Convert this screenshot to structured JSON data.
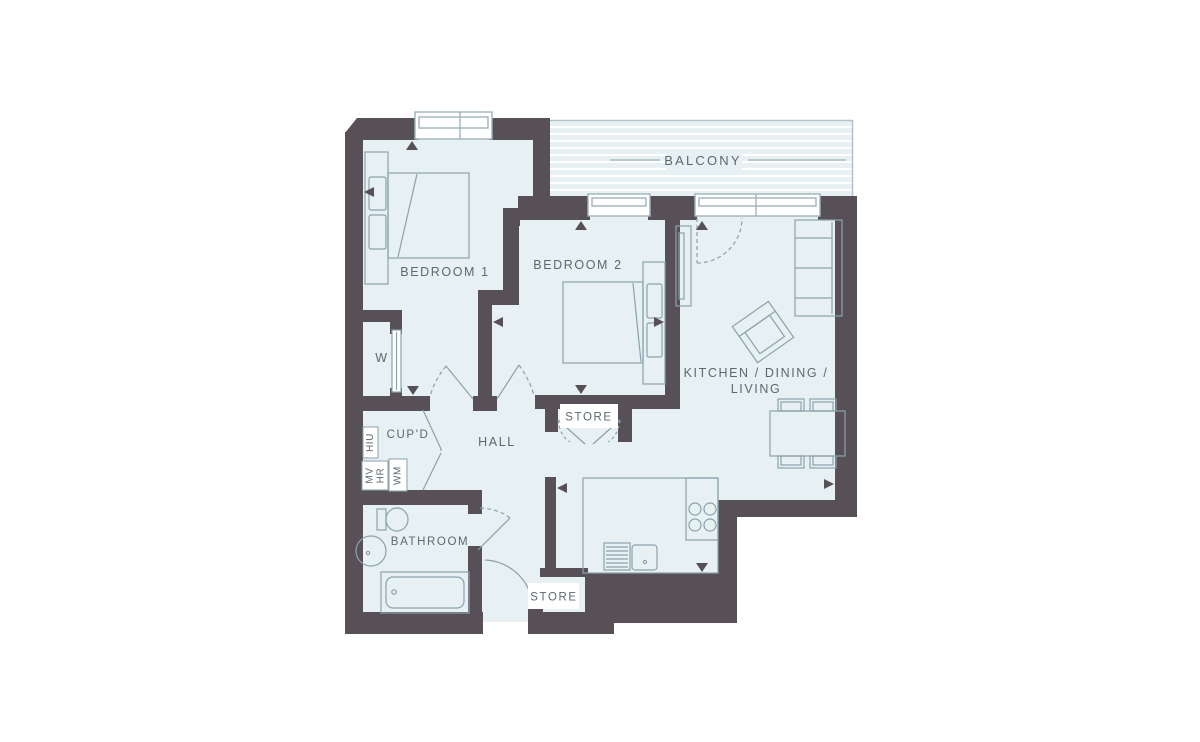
{
  "plan_title": "Two bedroom apartment floor plan",
  "colors": {
    "wall": "#575157",
    "floor": "#e7f0f2",
    "furniture_line": "#8ba2ab",
    "window_frame": "#9fb3b9",
    "label_text": "#5d696e",
    "background": "#ffffff"
  },
  "rooms": {
    "balcony": {
      "label": "BALCONY"
    },
    "bedroom1": {
      "label": "BEDROOM 1"
    },
    "bedroom2": {
      "label": "BEDROOM 2"
    },
    "kitchen_dining_living": {
      "label_line1": "KITCHEN / DINING /",
      "label_line2": "LIVING"
    },
    "hall": {
      "label": "HALL"
    },
    "cupboard": {
      "label": "CUP'D"
    },
    "wardrobe": {
      "label": "W"
    },
    "bathroom": {
      "label": "BATHROOM"
    },
    "store_upper": {
      "label": "STORE"
    },
    "store_entry": {
      "label": "STORE"
    }
  },
  "utility_labels": {
    "hiu": "HIU",
    "mv": "MV",
    "hr": "HR",
    "wm": "WM"
  },
  "fixtures": [
    "double-bed",
    "double-bed",
    "sofa",
    "armchair",
    "dining-table-4-chairs",
    "kitchen-counter",
    "hob",
    "sink-drainer",
    "wardrobe-unit",
    "toilet",
    "basin",
    "bathtub",
    "sliding-wardrobe-door"
  ]
}
